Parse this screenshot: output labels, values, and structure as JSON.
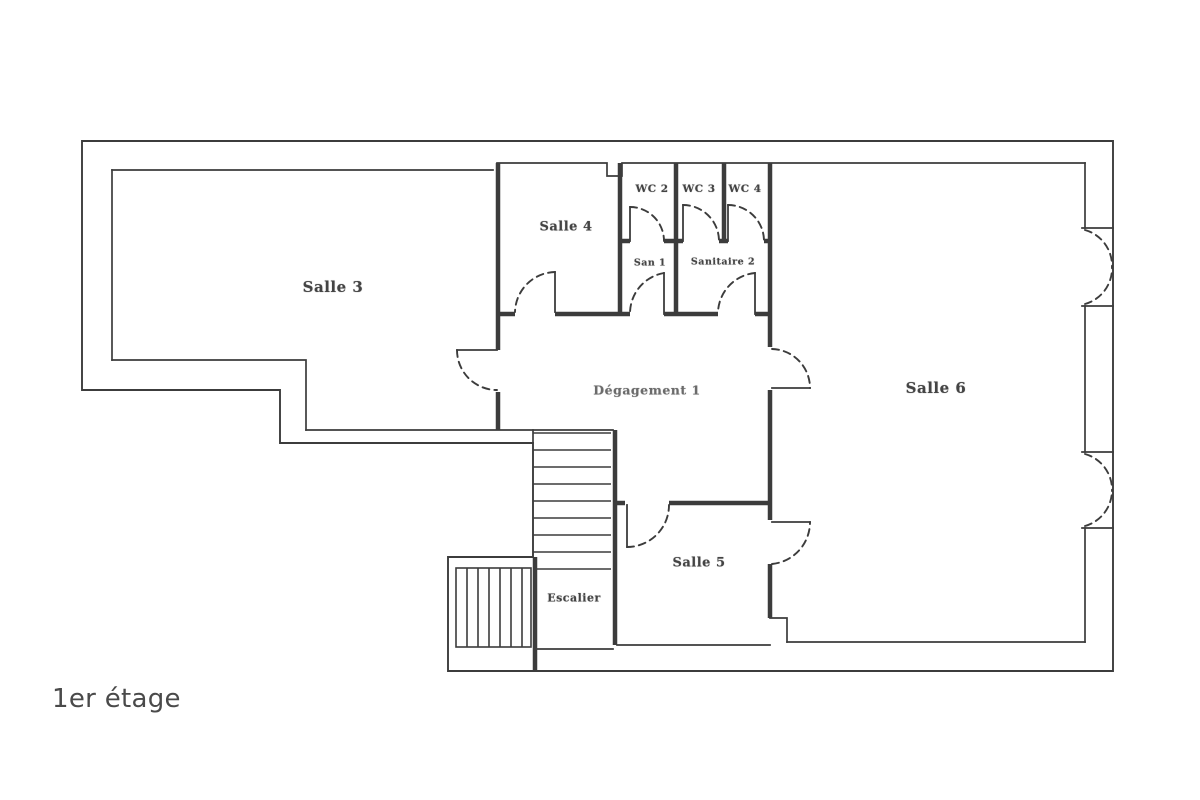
{
  "page": {
    "label": "1er étage",
    "background": "#ffffff"
  },
  "colors": {
    "line": "#2e2e2e",
    "room_label": "#1c1c1c",
    "floor_label": "#4a4a4a"
  },
  "plan": {
    "kind": "scanned architectural floor plan",
    "floor_label": "1er étage",
    "rooms": [
      {
        "id": "salle-3",
        "label": "Salle 3"
      },
      {
        "id": "salle-4",
        "label": "Salle 4"
      },
      {
        "id": "wc-2",
        "label": "WC 2"
      },
      {
        "id": "wc-3",
        "label": "WC 3"
      },
      {
        "id": "wc-4",
        "label": "WC 4"
      },
      {
        "id": "san-1",
        "label": "San 1"
      },
      {
        "id": "sanitaire-2",
        "label": "Sanitaire 2"
      },
      {
        "id": "degagement-1",
        "label": "Dégagement 1"
      },
      {
        "id": "salle-5",
        "label": "Salle 5"
      },
      {
        "id": "salle-6",
        "label": "Salle 6"
      },
      {
        "id": "escalier",
        "label": "Escalier"
      }
    ]
  }
}
